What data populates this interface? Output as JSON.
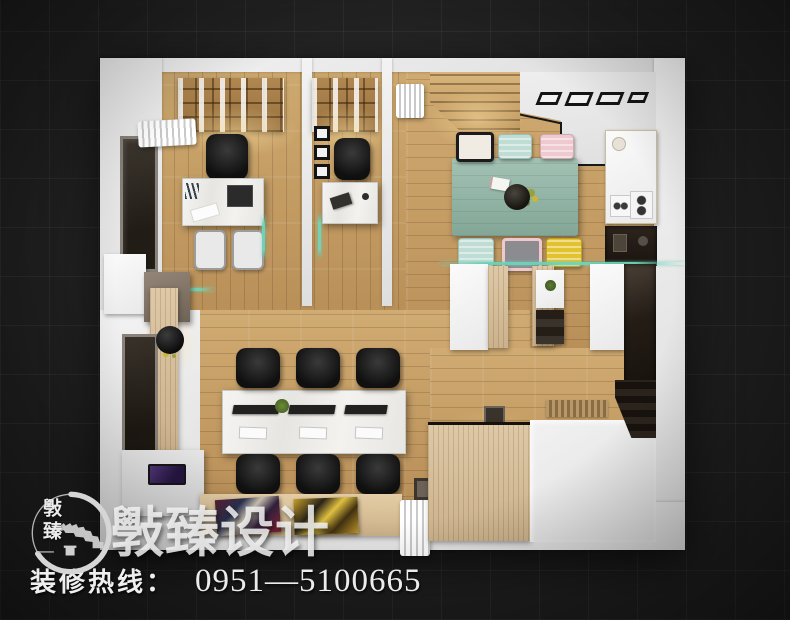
{
  "branding": {
    "logo_vertical_text": "斅臻",
    "watermark_text": "斅臻设计",
    "hotline_label": "装修热线：",
    "hotline_number": "0951—5100665"
  },
  "palette": {
    "background": "#1f1f1f",
    "grid_line": "#2b2b2b",
    "wall_white": "#e9e9e9",
    "wood_floor": "#c49d66",
    "wood_dark": "#a37e4c",
    "meeting_table_teal": "#8fb3a6",
    "chair_mint": "#bfddd4",
    "chair_pink": "#eec9cf",
    "chair_yellow": "#e2c22f",
    "chair_black": "#141414",
    "glass_teal": "#6fd4b9",
    "text_white": "#ededed"
  },
  "icons": {
    "logo": "great-wall-circle-logo"
  }
}
